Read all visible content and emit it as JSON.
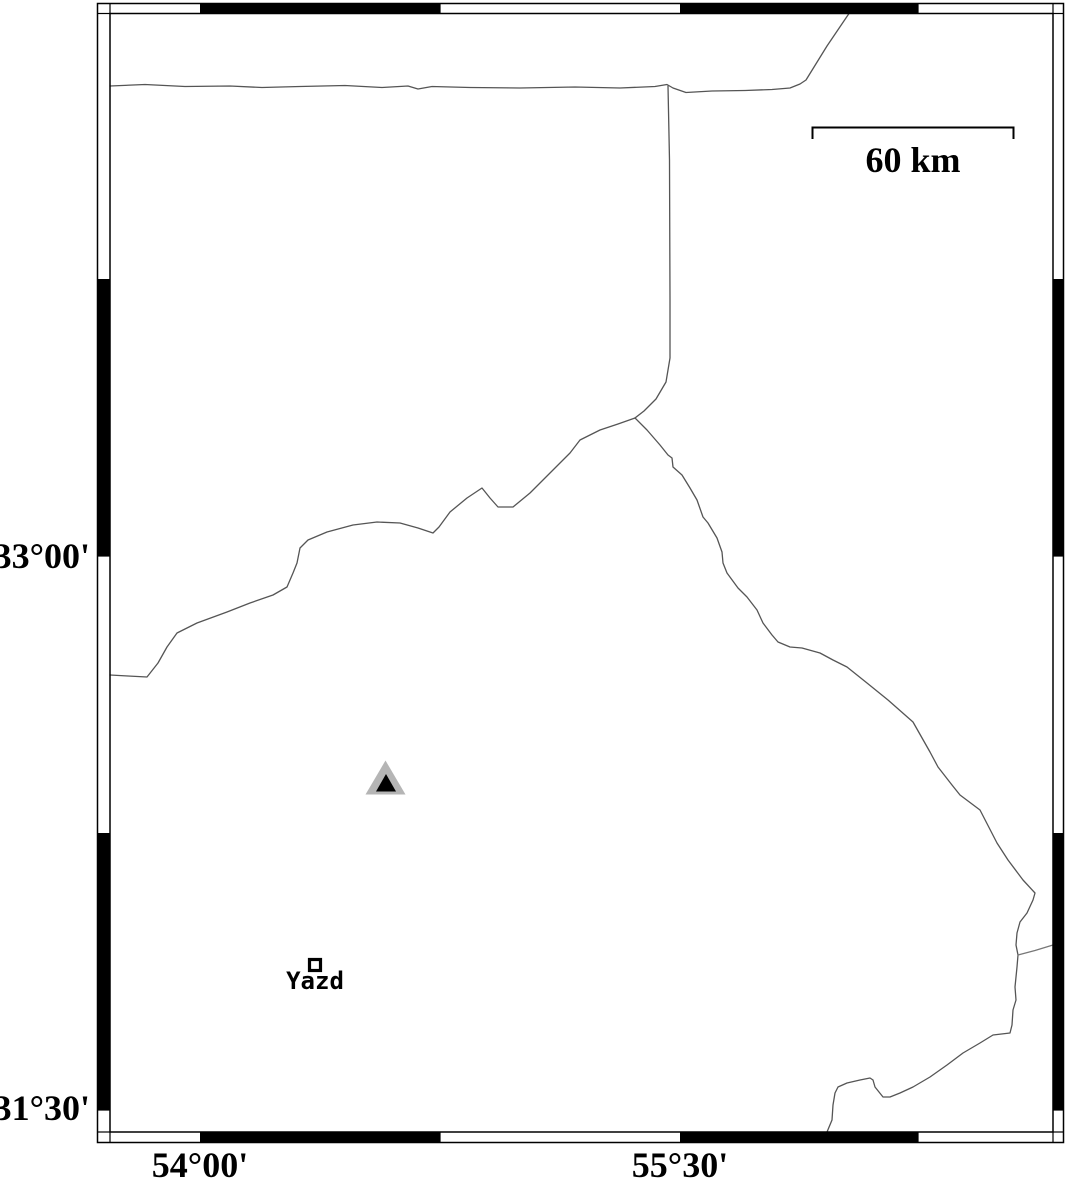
{
  "map": {
    "left_axis": {
      "labels": [
        {
          "text": "33°00'"
        },
        {
          "text": "31°30'"
        }
      ]
    },
    "bottom_axis": {
      "labels": [
        {
          "text": "54°00'"
        },
        {
          "text": "55°30'"
        }
      ]
    },
    "scale_bar": {
      "label": "60 km"
    },
    "markers": {
      "station": {
        "symbol": "triangle",
        "outer_color": "#b5b5b5",
        "inner_color": "#000000"
      },
      "city": {
        "label": "Yazd",
        "symbol": "square"
      }
    },
    "colors": {
      "background": "#ffffff",
      "frame": "#000000",
      "boundary_line": "#555555"
    }
  }
}
